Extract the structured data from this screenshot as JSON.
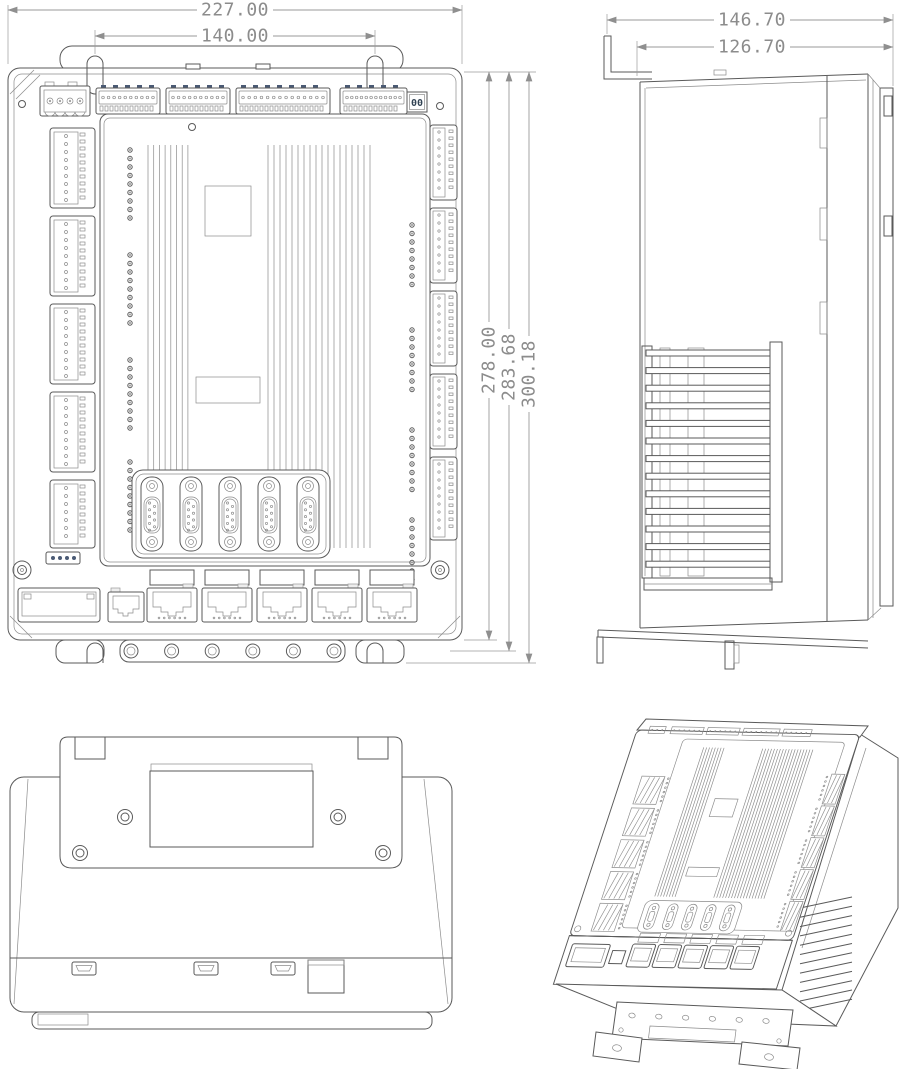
{
  "colors": {
    "line": "#5a5a5a",
    "line_thin": "#8c8c8c",
    "dimension": "#9a9a9a",
    "accent_pin": "#4a5a74",
    "background": "#ffffff"
  },
  "dimensions": {
    "front": {
      "overall_width": "227.00",
      "mount_hole_spacing": "140.00",
      "body_height": "278.00",
      "mid_height": "283.68",
      "overall_height": "300.18"
    },
    "side": {
      "overall_depth": "146.70",
      "body_depth": "126.70"
    }
  },
  "front_panel": {
    "address_display": "00",
    "top_strip_pins": [
      10,
      10,
      14,
      12
    ],
    "power_pin_count": 4,
    "left_connector_count": 5,
    "right_connector_count": 5,
    "led_groups_left": 4,
    "leds_per_group_left": 9,
    "led_groups_right": 4,
    "leds_per_group_right": 8,
    "fin_counts": [
      8,
      18
    ],
    "serial_port_count": 5,
    "ethernet_port_count": 5,
    "flange_hole_count": 6
  },
  "side_panel": {
    "fin_slat_count": 13,
    "divider_slot_count": 3
  },
  "bottom_panel": {
    "usb_port_count": 3,
    "screw_count": 4
  },
  "iso": {
    "heatsink_slat_count": 12
  }
}
